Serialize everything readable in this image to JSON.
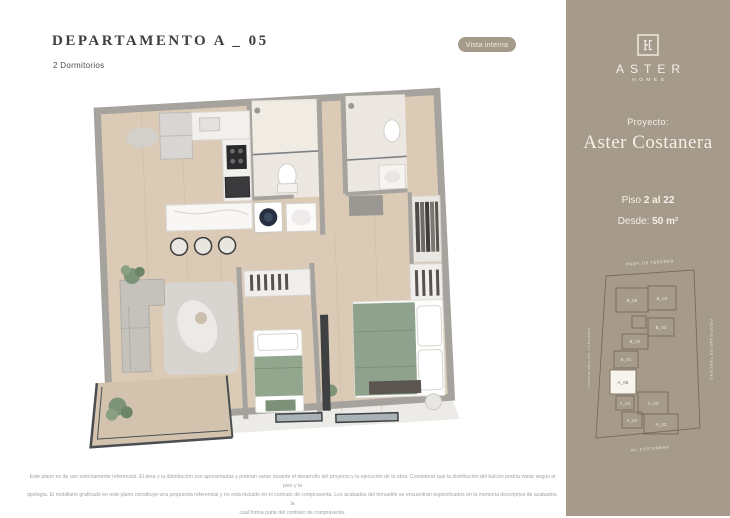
{
  "header": {
    "title": "DEPARTAMENTO A _ 05",
    "subtitle": "2 Dormitorios",
    "badge": "Vista interna"
  },
  "sidebar": {
    "logo": {
      "brand": "ASTER",
      "sub": "HOMES"
    },
    "project_label": "Proyecto:",
    "project_name": "Aster Costanera",
    "floor_prefix": "Piso",
    "floor_value": "2 al 22",
    "area_prefix": "Desde:",
    "area_value": "50 m²",
    "plate": {
      "top_label": "PROP. DE TERCERO",
      "left_label": "PROPIEDAD DE TERCERO",
      "right_label": "PROPIEDAD DE TERCERO",
      "bottom_label": "AV. COSTANERA",
      "highlighted_unit": "A_05",
      "units": [
        "B_05",
        "B_04",
        "B_03",
        "B_02",
        "B_01",
        "A_05",
        "A_04",
        "A_03",
        "A_01",
        "A_02"
      ]
    }
  },
  "disclaimer": {
    "line1": "Este plano es de uso estrictamente referencial. El área y la distribución son aproximadas y podrían variar durante el desarrollo del proyecto y la ejecución de la obra. Considerar que la distribución del balcón podría variar según el piso y la",
    "line2": "tipología. El mobiliario graficado en este plano constituye una propuesta referencial y no está incluido en el contrato de compraventa. Los acabados del inmueble se encuentran especificados en la memoria descriptiva de acabados, la",
    "line3": "cual forma parte del contrato de compraventa."
  },
  "colors": {
    "sidebar_bg": "#a69a8b",
    "badge_bg": "#a69a8b",
    "sidebar_text": "#f5f0e7",
    "title_text": "#3f3e3c",
    "wood_floor": "#dbcbb6",
    "wall": "#a6a39e",
    "bed_green": "#8fa28d",
    "plate_line": "#776a58",
    "disclaimer_text": "#a2a2a2"
  }
}
